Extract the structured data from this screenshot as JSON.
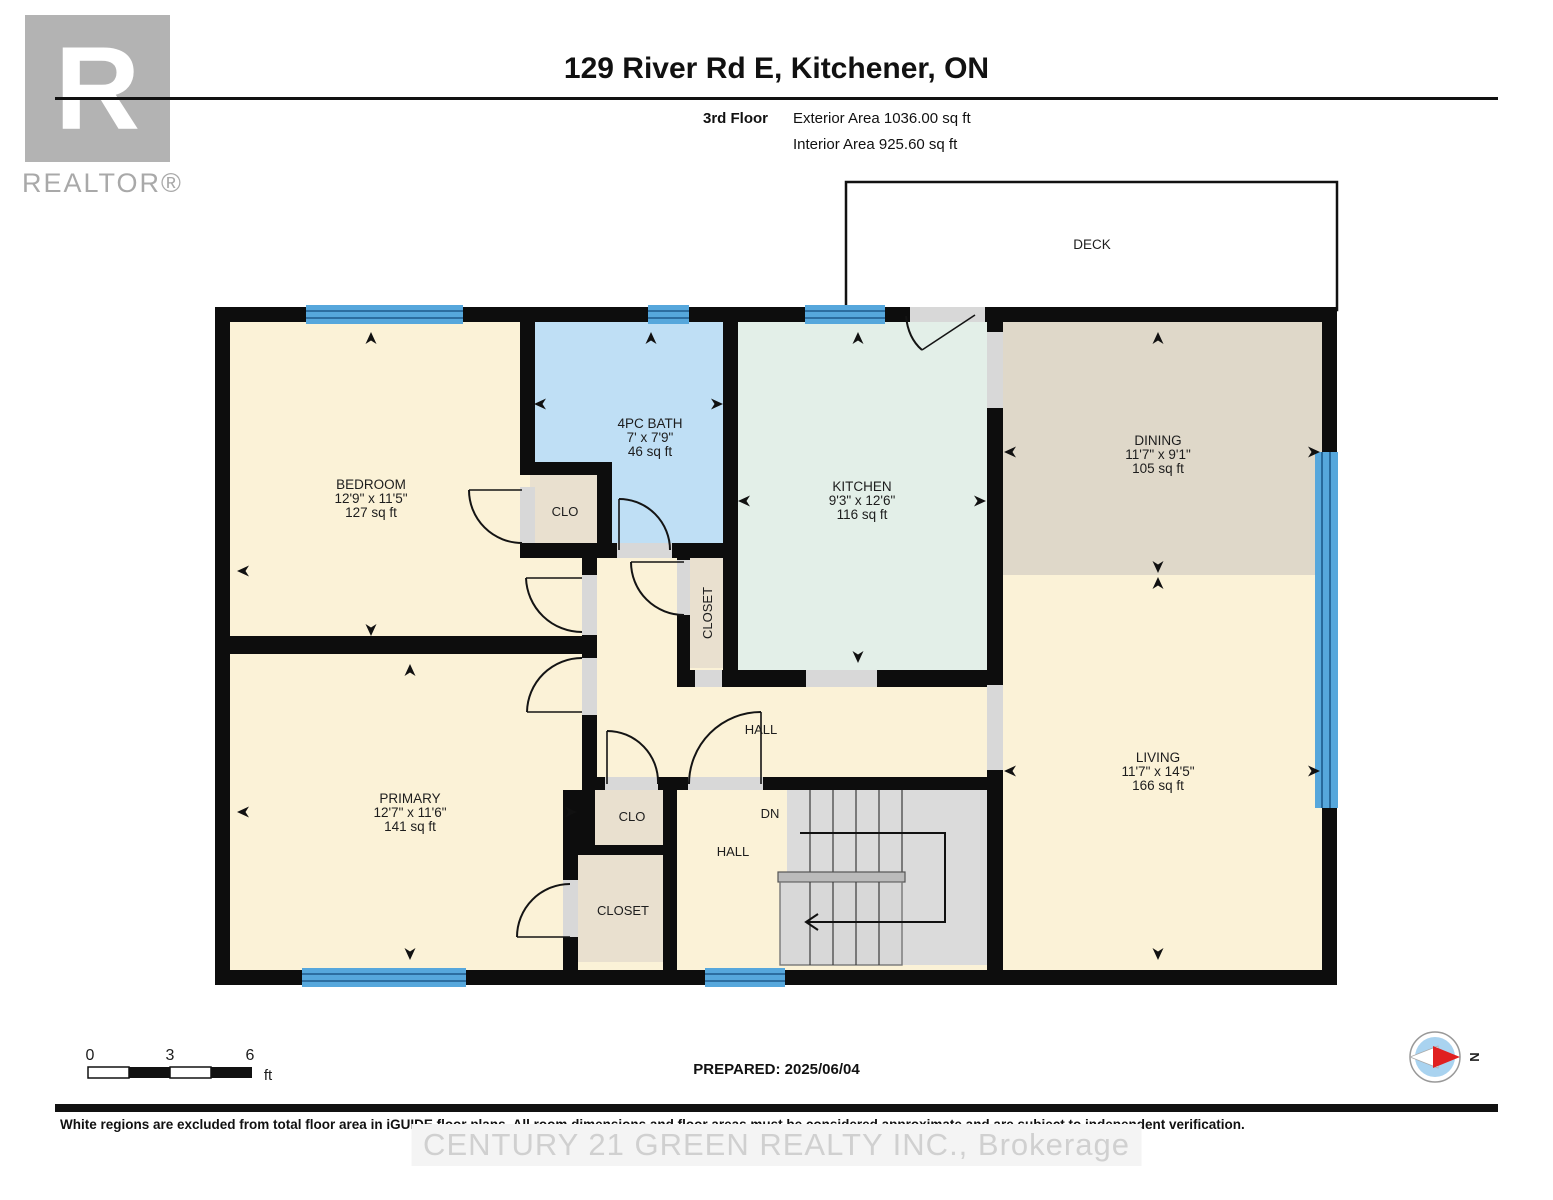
{
  "header": {
    "title": "129 River Rd E, Kitchener, ON",
    "floor_label": "3rd Floor",
    "exterior_area": "Exterior Area 1036.00 sq ft",
    "interior_area": "Interior Area 925.60 sq ft"
  },
  "logo": {
    "letter": "R",
    "realtor": "REALTOR®"
  },
  "plan": {
    "deck_label": "DECK",
    "rooms": [
      {
        "name": "BEDROOM",
        "dims": "12'9\" x 11'5\"",
        "area": "127 sq ft"
      },
      {
        "name": "4PC BATH",
        "dims": "7' x 7'9\"",
        "area": "46 sq ft"
      },
      {
        "name": "KITCHEN",
        "dims": "9'3\" x 12'6\"",
        "area": "116 sq ft"
      },
      {
        "name": "DINING",
        "dims": "11'7\" x 9'1\"",
        "area": "105 sq ft"
      },
      {
        "name": "LIVING",
        "dims": "11'7\" x 14'5\"",
        "area": "166 sq ft"
      },
      {
        "name": "PRIMARY",
        "dims": "12'7\" x 11'6\"",
        "area": "141 sq ft"
      }
    ],
    "labels": {
      "hall_upper": "HALL",
      "hall_lower": "HALL",
      "dn": "DN",
      "clo_upper": "CLO",
      "clo_lower": "CLO",
      "closet_lower": "CLOSET",
      "closet_vertical": "CLOSET"
    }
  },
  "footer": {
    "scale": {
      "t0": "0",
      "t3": "3",
      "t6": "6",
      "unit": "ft"
    },
    "prepared": "PREPARED: 2025/06/04",
    "compass_n": "N",
    "disclaimer": "White regions are excluded from total floor area in iGUIDE floor plans. All room dimensions and floor areas must be considered approximate and are subject to independent verification.",
    "watermark": "CENTURY 21 GREEN REALTY INC., Brokerage"
  },
  "colors": {
    "wall": "#0d0d0d",
    "floor_cream": "#FBF2D7",
    "bath_blue": "#BFDFF5",
    "kitchen_mint": "#E3EFE8",
    "dining_tan": "#DFD8C9",
    "closet_tan": "#E9E0CF",
    "window_blue": "#56A7DC",
    "stairs_gray": "#DBDBDB",
    "opening_gray": "#D8D8D8"
  }
}
